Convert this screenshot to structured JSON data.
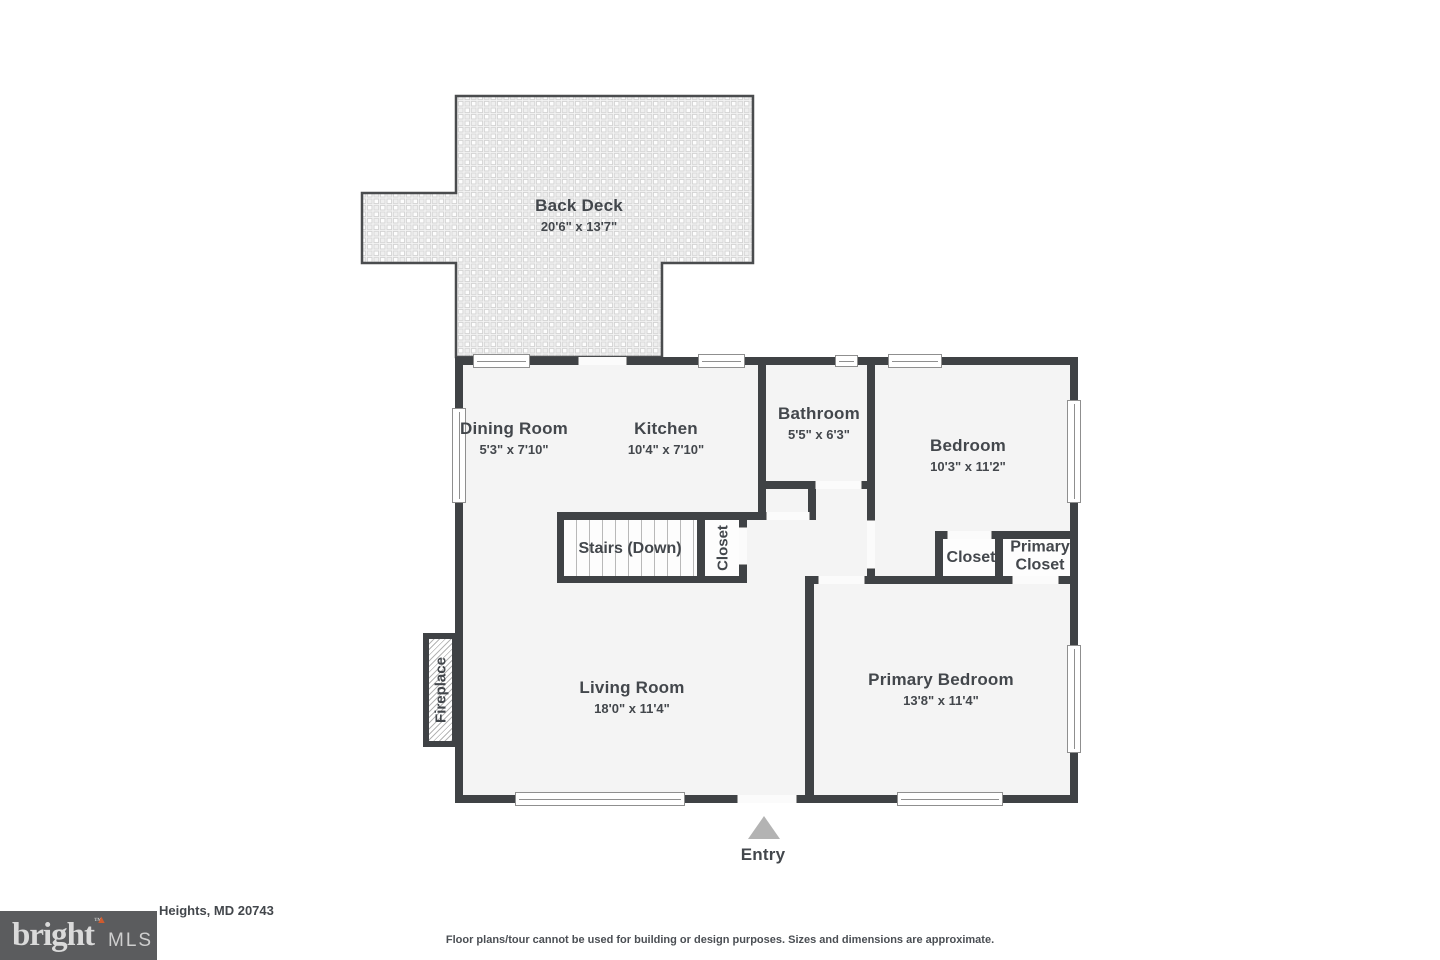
{
  "plan": {
    "rooms": [
      {
        "name": "Back Deck",
        "dims": "20'6\" x 13'7\""
      },
      {
        "name": "Dining Room",
        "dims": "5'3\" x 7'10\""
      },
      {
        "name": "Kitchen",
        "dims": "10'4\" x 7'10\""
      },
      {
        "name": "Bathroom",
        "dims": "5'5\" x 6'3\""
      },
      {
        "name": "Bedroom",
        "dims": "10'3\" x 11'2\""
      },
      {
        "name": "Stairs (Down)"
      },
      {
        "name": "Closet"
      },
      {
        "name": "Closet"
      },
      {
        "name": "Primary",
        "name2": "Closet"
      },
      {
        "name": "Living Room",
        "dims": "18'0\" x 11'4\""
      },
      {
        "name": "Primary Bedroom",
        "dims": "13'8\" x 11'4\""
      },
      {
        "name": "Fireplace"
      }
    ],
    "entry_label": "Entry"
  },
  "footer": {
    "address_visible": "Heights, MD 20743",
    "disclaimer": "Floor plans/tour cannot be used for building or design purposes. Sizes and dimensions are approximate.",
    "logo": {
      "brand": "bright",
      "tm": "™",
      "suffix": "MLS",
      "accent_color": "#cf5b2e"
    }
  },
  "colors": {
    "wall": "#3f4245",
    "floor": "#f4f4f4",
    "text": "#43474c",
    "entry_arrow": "#b3b3b3",
    "logo_bg": "#5b5c5e"
  }
}
